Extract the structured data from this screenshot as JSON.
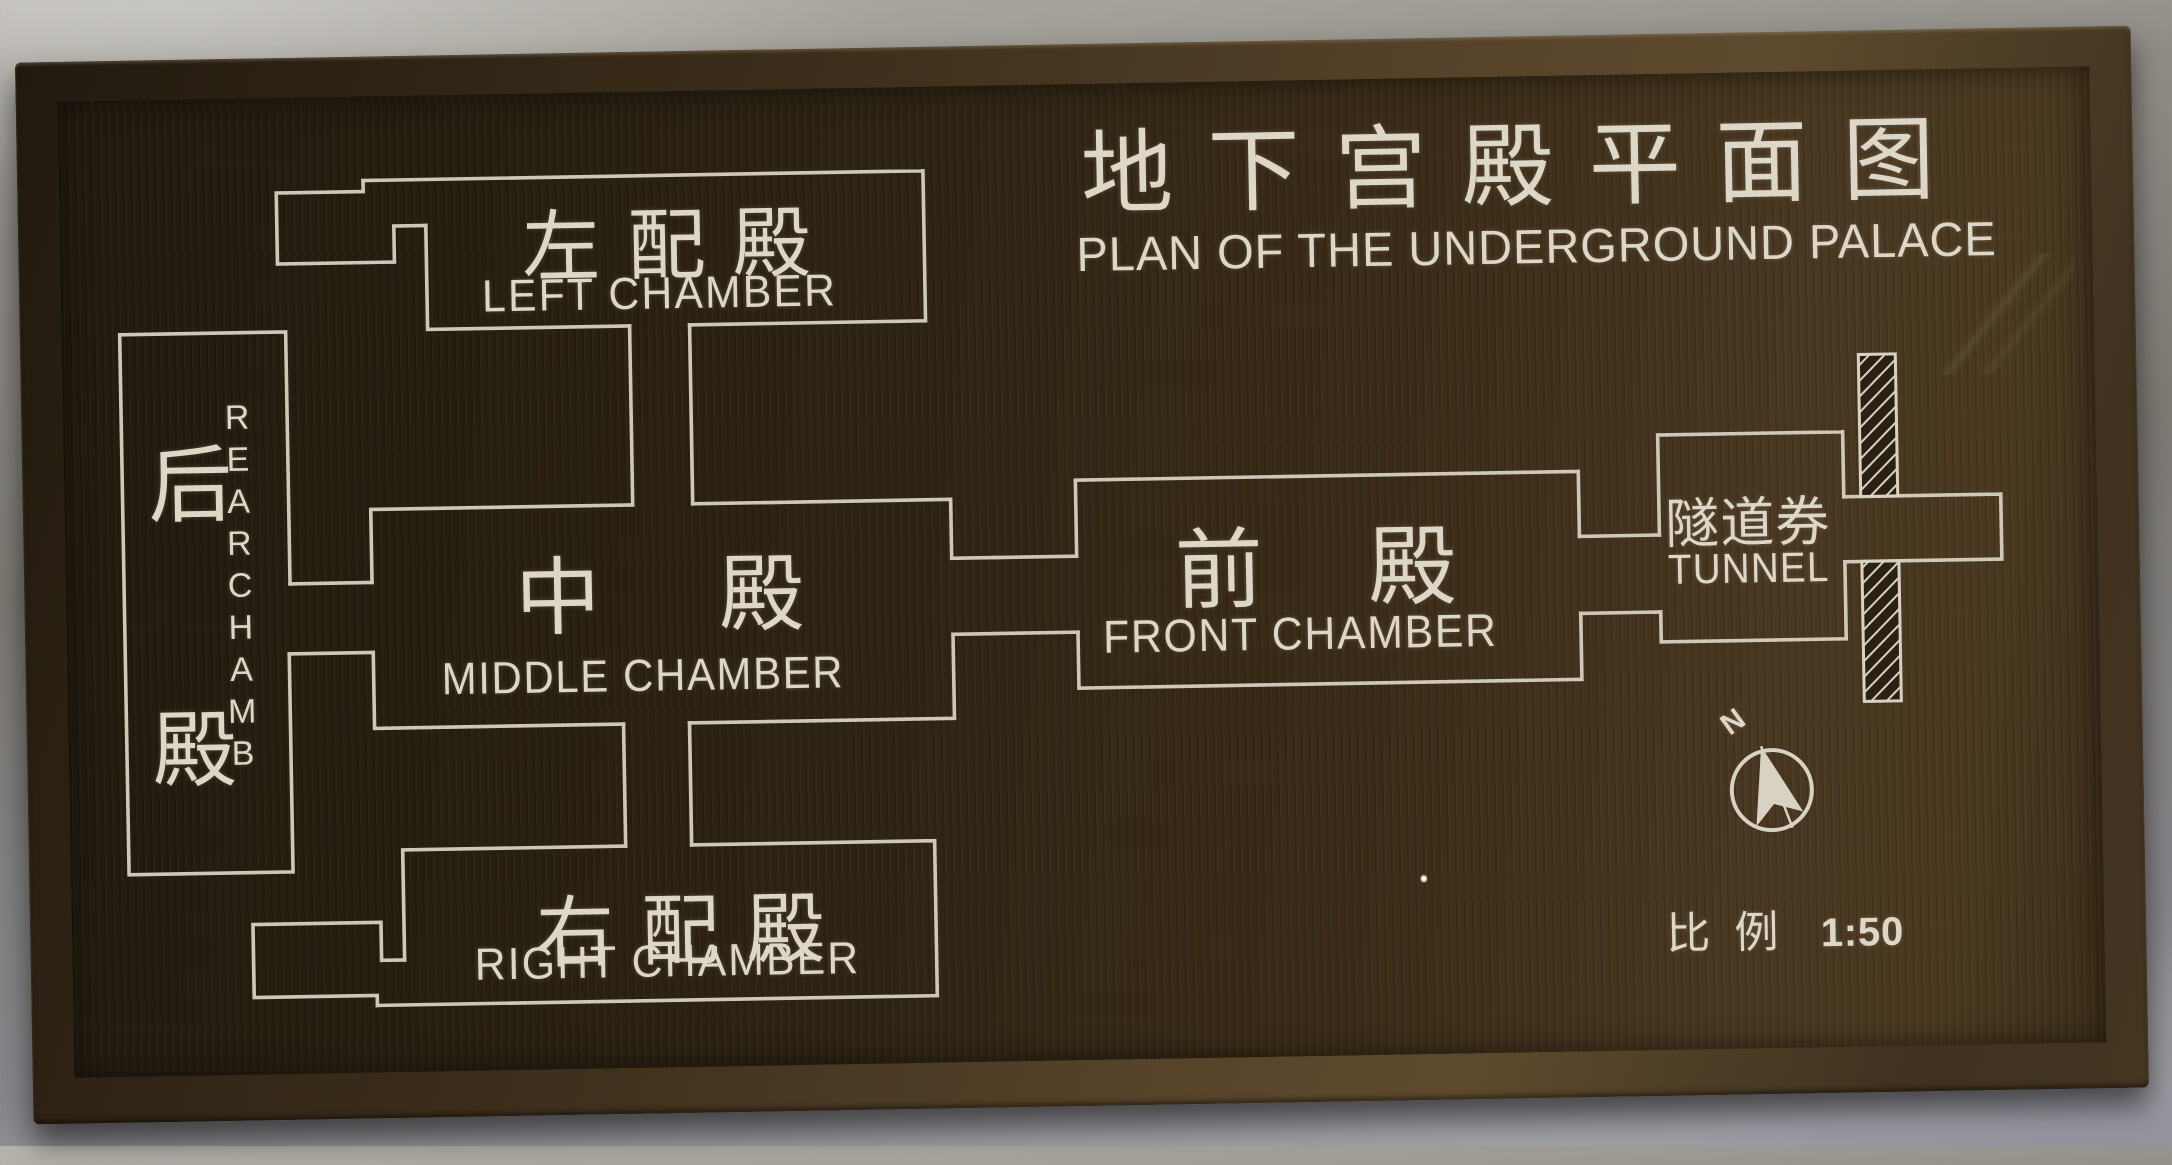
{
  "sign": {
    "title": {
      "cn": "地下宫殿平面图",
      "en": "PLAN OF THE UNDERGROUND PALACE"
    },
    "chambers": {
      "left": {
        "cn": "左配殿",
        "en": "LEFT CHAMBER"
      },
      "rear": {
        "cn": "后殿",
        "en": "REAR CHAMB"
      },
      "middle": {
        "cn": "中殿",
        "en": "MIDDLE CHAMBER"
      },
      "front": {
        "cn": "前殿",
        "en": "FRONT CHAMBER"
      },
      "right": {
        "cn": "右配殿",
        "en": "RIGHT CHAMBER"
      },
      "tunnel": {
        "cn": "隧道券",
        "en": "TUNNEL"
      }
    },
    "compass": {
      "north_label": "N"
    },
    "scale": {
      "label_cn": "比例",
      "value": "1:50"
    },
    "colors": {
      "engraved_line": "#d8d2c3",
      "plaque_dark": "#221a0f",
      "plaque_light": "#4a3920",
      "frame_bronze": "#55422a",
      "wall_gray": "#8f8c86"
    }
  }
}
